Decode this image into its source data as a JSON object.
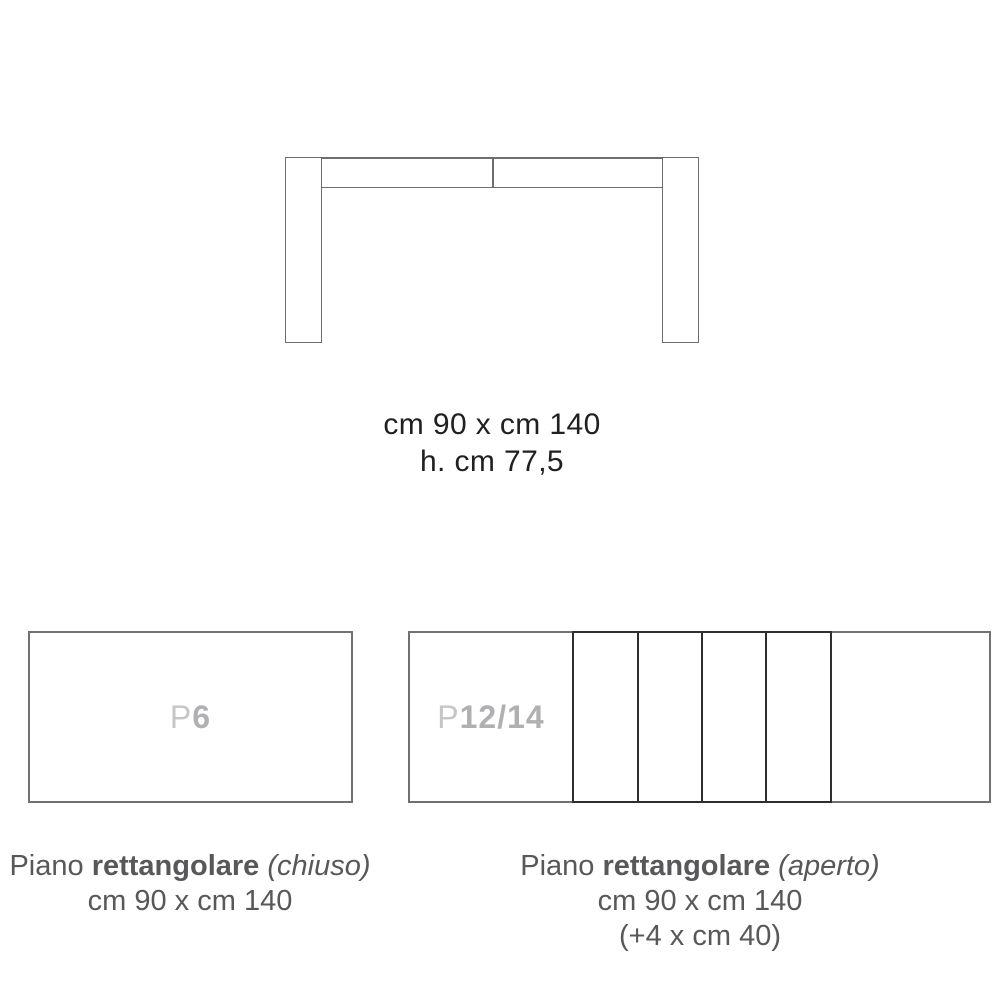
{
  "colors": {
    "bg": "#ffffff",
    "line-gray": "#6e6e71",
    "panel-gray": "#717174",
    "line-dark": "#2e2e30",
    "ink": "#202022",
    "caption": "#58585b",
    "label-light": "#c6c6c8",
    "label-strong": "#b0b0b3"
  },
  "front_view": {
    "dimensions_line1": "cm 90 x cm 140",
    "dimensions_line2": "h. cm 77,5"
  },
  "closed_top": {
    "label_prefix": "P",
    "label_value": "6",
    "caption_word1": "Piano",
    "caption_word2": "rettangolare",
    "caption_word3": "(chiuso)",
    "caption_line2": "cm 90 x cm 140"
  },
  "open_top": {
    "label_prefix": "P",
    "label_value": "12/14",
    "caption_word1": "Piano",
    "caption_word2": "rettangolare",
    "caption_word3": "(aperto)",
    "caption_line2": "cm 90 x cm 140",
    "caption_line3": "(+4 x cm 40)"
  }
}
